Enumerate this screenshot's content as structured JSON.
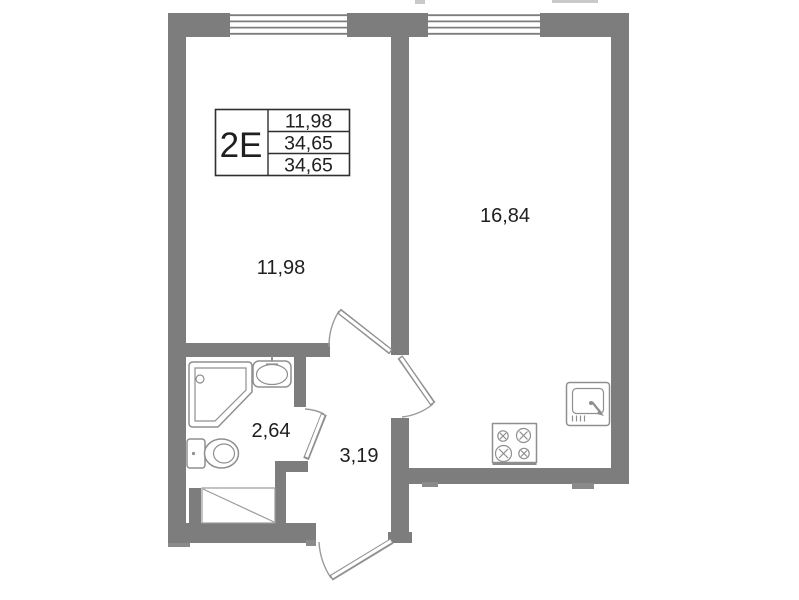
{
  "plan": {
    "legend": {
      "type_code": "2Е",
      "rows": [
        "11,98",
        "34,65",
        "34,65"
      ]
    },
    "rooms": [
      {
        "id": "room",
        "area": "11,98"
      },
      {
        "id": "kitchen-living",
        "area": "16,84"
      },
      {
        "id": "bathroom",
        "area": "2,64"
      },
      {
        "id": "hall",
        "area": "3,19"
      }
    ],
    "colors": {
      "wall": "#7d7d7d",
      "fixture_line": "#8f8f8f",
      "table_border": "#2f2f2f",
      "text": "#1f1f1f",
      "background": "#ffffff"
    }
  }
}
